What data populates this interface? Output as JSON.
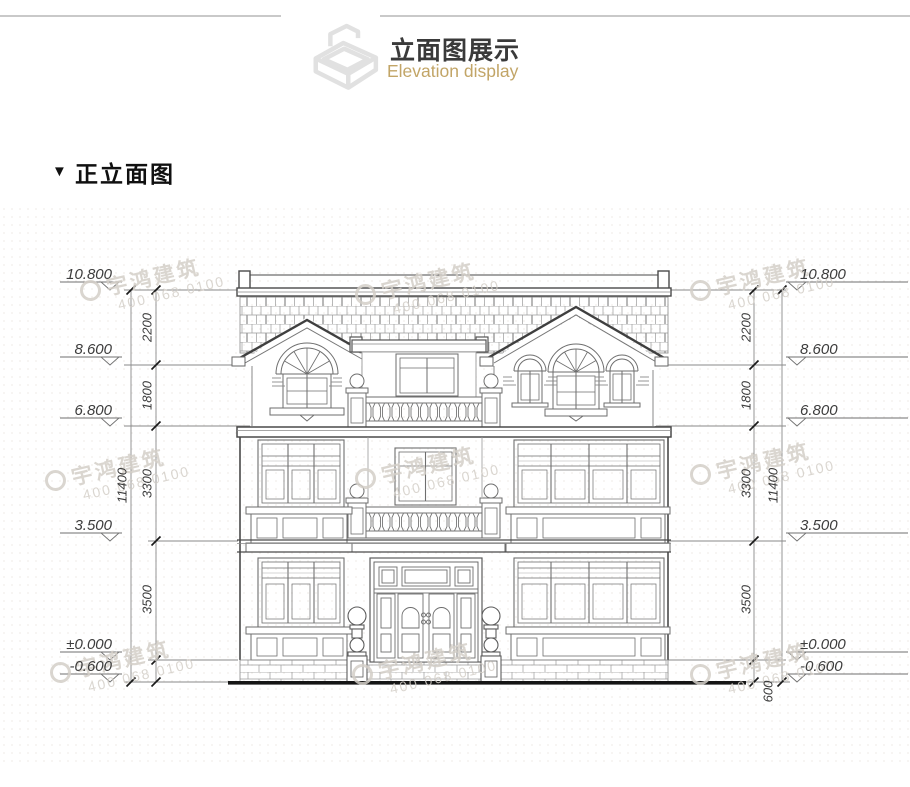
{
  "header": {
    "title": "立面图展示",
    "subtitle": "Elevation display"
  },
  "section": {
    "marker": "▼",
    "title": "正立面图"
  },
  "watermark": {
    "brand": "宇鸿建筑",
    "phone": "400 068 0100"
  },
  "dimensions": {
    "levels_left": [
      "10.800",
      "8.600",
      "6.800",
      "3.500",
      "±0.000",
      "-0.600"
    ],
    "levels_right": [
      "10.800",
      "8.600",
      "6.800",
      "3.500",
      "±0.000",
      "-0.600"
    ],
    "chain_left": [
      "2200",
      "1800",
      "3300",
      "3500"
    ],
    "chain_right": [
      "2200",
      "1800",
      "3300",
      "3500"
    ],
    "overall_left": "11400",
    "overall_right": "11400",
    "bottom_right": "600"
  }
}
